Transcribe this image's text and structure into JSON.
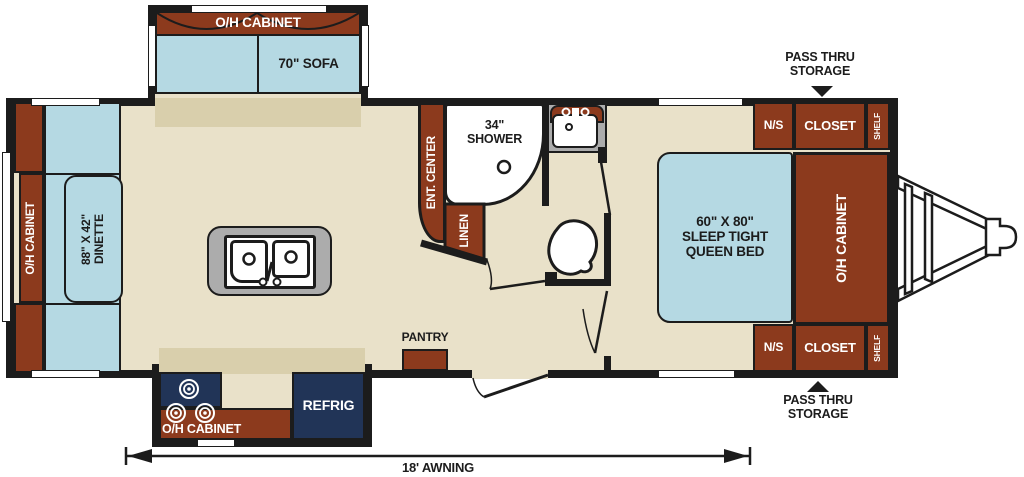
{
  "colors": {
    "floor": "#E9E1C9",
    "floor_shade": "#D9CFAC",
    "cabinet": "#8C3A1D",
    "seat": "#B5D9E3",
    "appliance": "#213457",
    "counter": "#ACACAC",
    "wall": "#1C1C1C",
    "text_dark": "#1C1C1C"
  },
  "labels": {
    "sofa_cabinet": "O/H CABINET",
    "sofa": "70\" SOFA",
    "dinette_cabinet": "O/H CABINET",
    "dinette_table": "88\" X 42\"\nDINETTE",
    "ent_center": "ENT. CENTER",
    "shower": "34\"\nSHOWER",
    "linen": "LINEN",
    "pantry": "PANTRY",
    "kitchen_cabinet": "O/H CABINET",
    "refrig": "REFRIG",
    "bed": "60\" X 80\"\nSLEEP TIGHT\nQUEEN BED",
    "bedroom_cabinet": "O/H CABINET",
    "ns_top": "N/S",
    "closet_top": "CLOSET",
    "shelf_top": "SHELF",
    "ns_bottom": "N/S",
    "closet_bottom": "CLOSET",
    "shelf_bottom": "SHELF",
    "pass_thru_top": "PASS THRU\nSTORAGE",
    "pass_thru_bottom": "PASS THRU\nSTORAGE",
    "awning": "18' AWNING"
  }
}
